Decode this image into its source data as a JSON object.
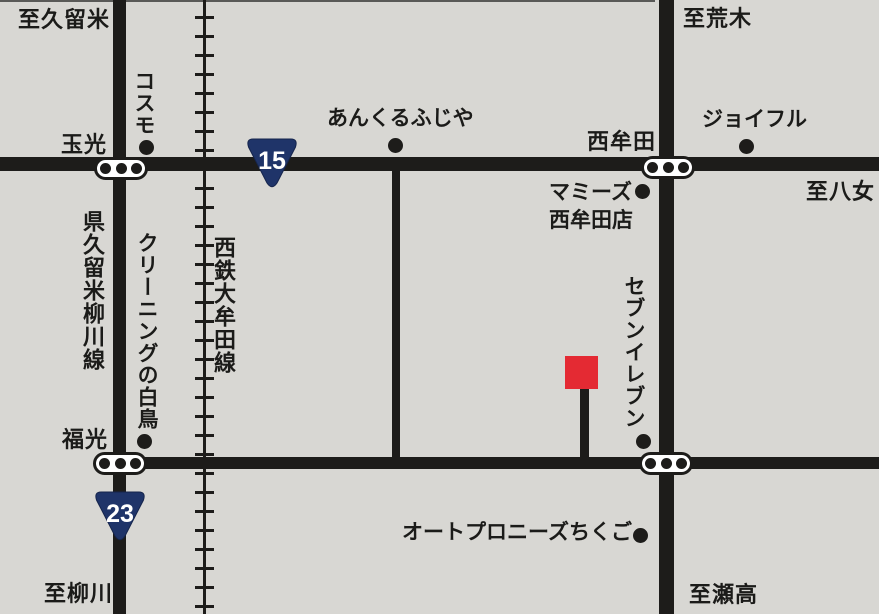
{
  "colors": {
    "bg": "#d8d7d3",
    "road": "#1d1c1a",
    "ink": "#1b1b19",
    "light": "#ffffff",
    "shield": "#1f3469",
    "marker": "#e42a33"
  },
  "destinations": {
    "kurume": "至久留米",
    "araki": "至荒木",
    "yame": "至八女",
    "yanagawa": "至柳川",
    "setaka": "至瀬高"
  },
  "intersections": {
    "tamamitsu": "玉光",
    "nishimuta": "西牟田",
    "fukumitsu": "福光"
  },
  "roads": {
    "pref_kurume_yanagawa_line": "県久留米柳川線",
    "nishitetsu_omuta_line": "西鉄大牟田線"
  },
  "route_shields": {
    "r15": "15",
    "r23": "23"
  },
  "landmarks": {
    "cosmo": "コスモ",
    "ankuru_fujiya": "あんくるふじや",
    "joyful": "ジョイフル",
    "mamys_line1": "マミーズ",
    "mamys_line2": "西牟田店",
    "cleaning_hakucho": "クリーニングの白鳥",
    "seven_eleven": "セブンイレブン",
    "auto_pronies_chikugo": "オートプロニーズちくご"
  },
  "destination_marker": "red-square"
}
